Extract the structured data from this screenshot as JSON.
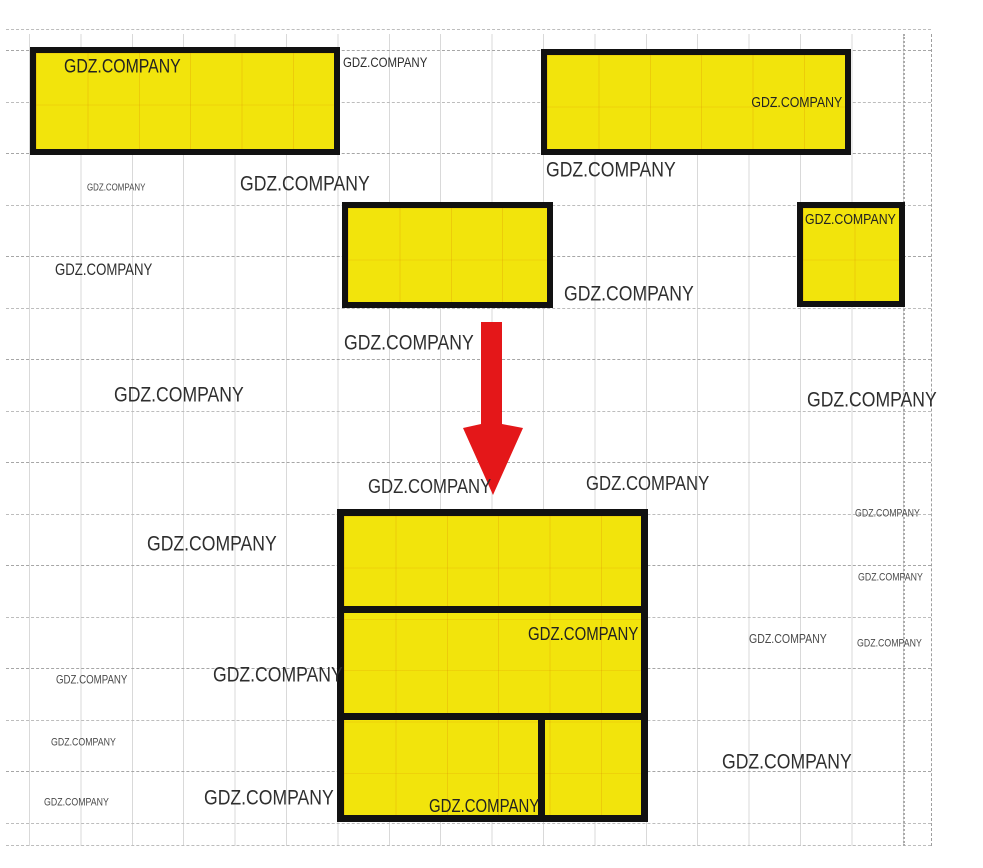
{
  "watermark_text": "GDZ.COMPANY",
  "colors": {
    "yellow": "#f2e40c",
    "red": "#e41719",
    "outline": "#111111",
    "grid_light": "#d9d9d9",
    "grid_dashed": "#bdbdbd",
    "text": "#2e2e2e"
  },
  "shapes": {
    "top_left": {
      "label": "GDZ.COMPANY"
    },
    "top_right": {
      "label": "GDZ.COMPANY"
    },
    "middle": {
      "label": ""
    },
    "small_right": {
      "label": "GDZ.COMPANY"
    },
    "result": {
      "row2_label": "GDZ.COMPANY",
      "row3_label": "GDZ.COMPANY"
    }
  },
  "arrow": {
    "direction": "down",
    "color": "#e41719"
  },
  "watermarks": [
    {
      "text": "GDZ.COMPANY",
      "x": 343,
      "y": 55,
      "fs": 13
    },
    {
      "text": "GDZ.COMPANY",
      "x": 546,
      "y": 158,
      "fs": 20
    },
    {
      "text": "GDZ.COMPANY",
      "x": 87,
      "y": 183,
      "fs": 9
    },
    {
      "text": "GDZ.COMPANY",
      "x": 240,
      "y": 172,
      "fs": 20
    },
    {
      "text": "GDZ.COMPANY",
      "x": 55,
      "y": 262,
      "fs": 15
    },
    {
      "text": "GDZ.COMPANY",
      "x": 564,
      "y": 282,
      "fs": 20
    },
    {
      "text": "GDZ.COMPANY",
      "x": 344,
      "y": 331,
      "fs": 20
    },
    {
      "text": "GDZ.COMPANY",
      "x": 114,
      "y": 383,
      "fs": 20
    },
    {
      "text": "GDZ.COMPANY",
      "x": 807,
      "y": 388,
      "fs": 20
    },
    {
      "text": "GDZ.COMPANY",
      "x": 368,
      "y": 477,
      "fs": 19
    },
    {
      "text": "GDZ.COMPANY",
      "x": 586,
      "y": 474,
      "fs": 19
    },
    {
      "text": "GDZ.COMPANY",
      "x": 147,
      "y": 532,
      "fs": 20
    },
    {
      "text": "GDZ.COMPANY",
      "x": 855,
      "y": 508,
      "fs": 10
    },
    {
      "text": "GDZ.COMPANY",
      "x": 858,
      "y": 572,
      "fs": 10
    },
    {
      "text": "GDZ.COMPANY",
      "x": 749,
      "y": 632,
      "fs": 12
    },
    {
      "text": "GDZ.COMPANY",
      "x": 857,
      "y": 638,
      "fs": 10
    },
    {
      "text": "GDZ.COMPANY",
      "x": 56,
      "y": 674,
      "fs": 11
    },
    {
      "text": "GDZ.COMPANY",
      "x": 213,
      "y": 663,
      "fs": 20
    },
    {
      "text": "GDZ.COMPANY",
      "x": 51,
      "y": 737,
      "fs": 10
    },
    {
      "text": "GDZ.COMPANY",
      "x": 722,
      "y": 750,
      "fs": 20
    },
    {
      "text": "GDZ.COMPANY",
      "x": 44,
      "y": 797,
      "fs": 10
    },
    {
      "text": "GDZ.COMPANY",
      "x": 204,
      "y": 786,
      "fs": 20
    }
  ]
}
